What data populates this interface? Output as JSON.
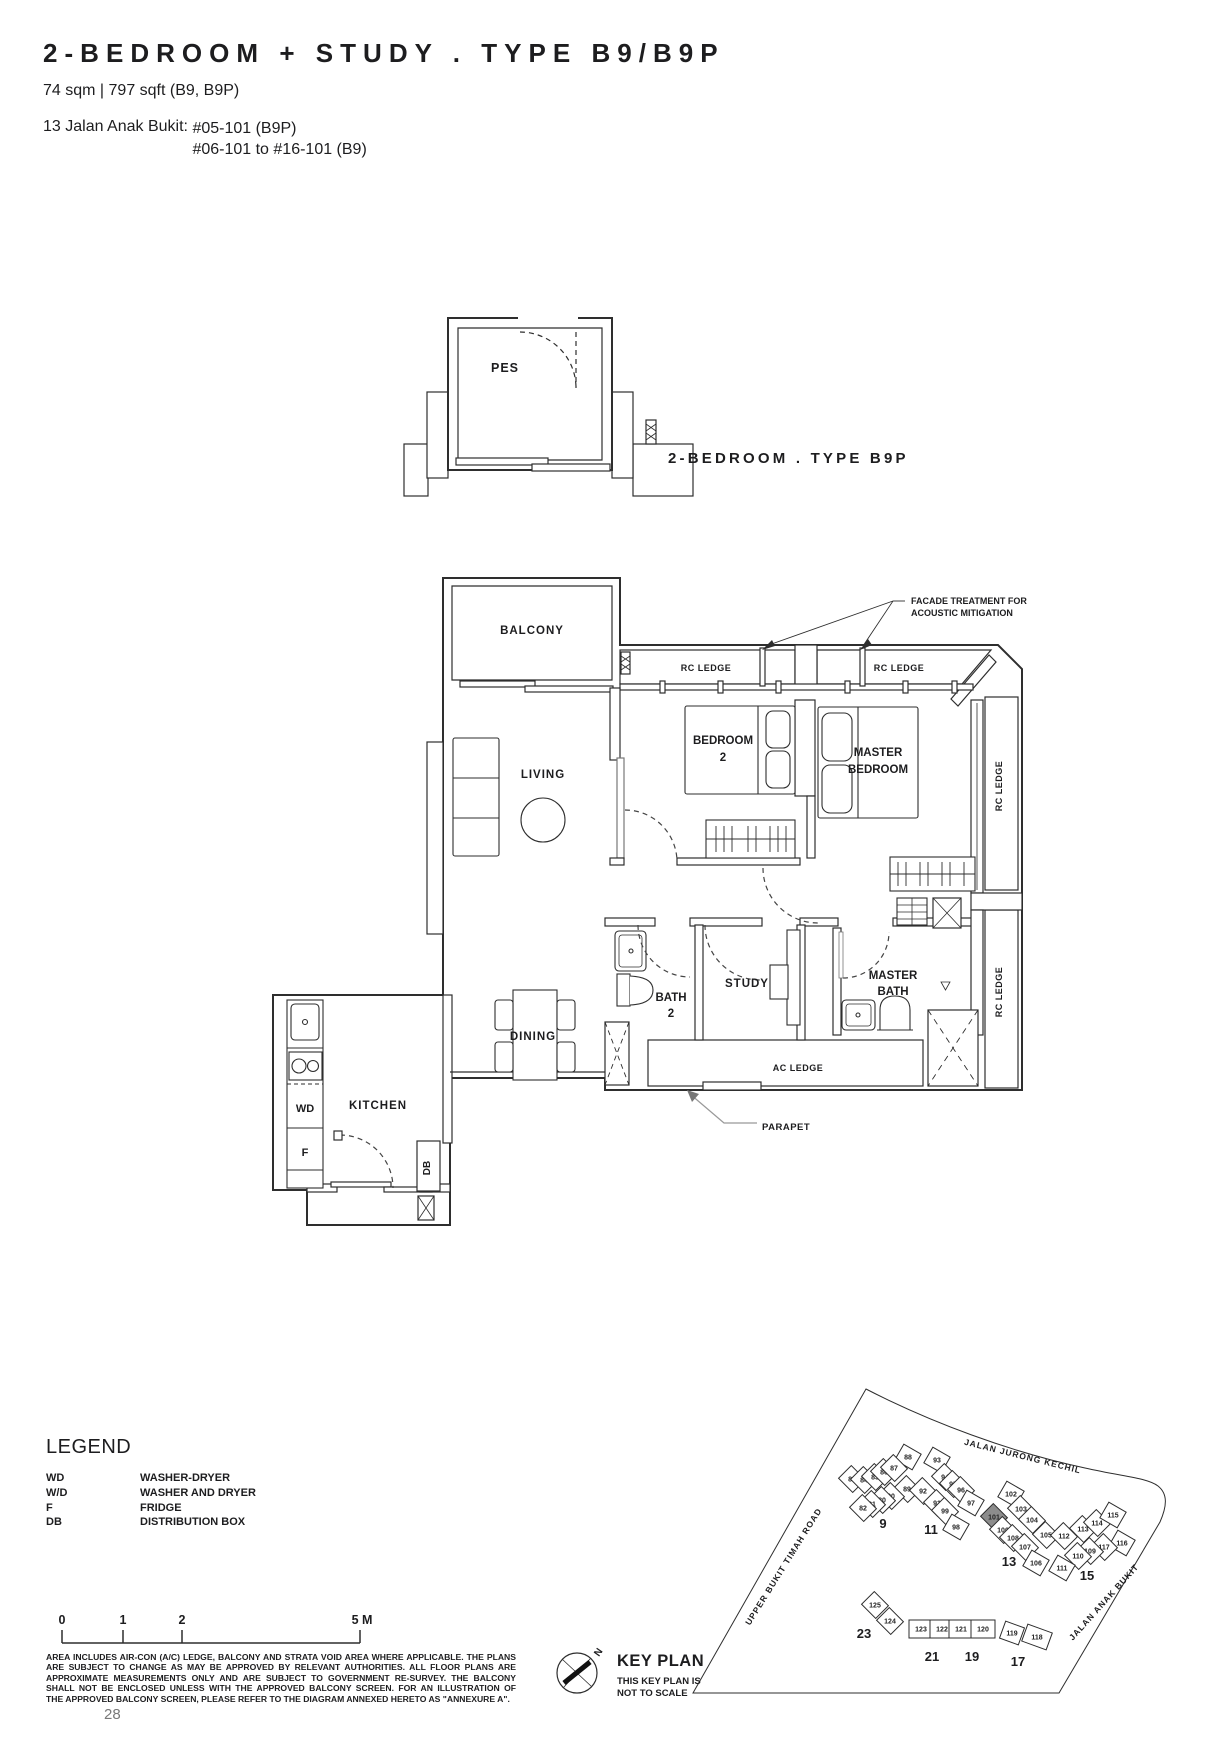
{
  "header": {
    "title": "2-BEDROOM + STUDY . TYPE B9/B9P",
    "area": "74 sqm | 797 sqft (B9, B9P)",
    "address_label": "13 Jalan Anak Bukit: ",
    "address_line1": "#05-101 (B9P)",
    "address_line2": "#06-101 to #16-101 (B9)"
  },
  "page": {
    "number": "28"
  },
  "floor_plan": {
    "labels": [
      {
        "name": "pes-label",
        "text": "PES",
        "x": 505,
        "y": 372,
        "size": 12.5,
        "ls": 1
      },
      {
        "name": "variant-type-label",
        "text": "2-BEDROOM . TYPE B9P",
        "x": 668,
        "y": 463,
        "size": 15,
        "ls": 3.2,
        "anchor": "start"
      },
      {
        "name": "balcony-label",
        "text": "BALCONY",
        "x": 532,
        "y": 634,
        "size": 11.5,
        "ls": 1
      },
      {
        "name": "rc-ledge-label-1",
        "text": "RC LEDGE",
        "x": 706,
        "y": 671,
        "size": 9,
        "ls": 0.5
      },
      {
        "name": "rc-ledge-label-2",
        "text": "RC LEDGE",
        "x": 899,
        "y": 671,
        "size": 9,
        "ls": 0.5
      },
      {
        "name": "facade-treatment-note",
        "lines": [
          "FACADE TREATMENT FOR",
          "ACOUSTIC MITIGATION"
        ],
        "x": 911,
        "y": 604,
        "size": 9,
        "anchor": "start",
        "dy": 12
      },
      {
        "name": "living-label",
        "text": "LIVING",
        "x": 543,
        "y": 778,
        "size": 11.5,
        "ls": 1
      },
      {
        "name": "bedroom2-label",
        "lines": [
          "BEDROOM",
          "2"
        ],
        "x": 723,
        "y": 744,
        "size": 11.5,
        "dy": 17
      },
      {
        "name": "master-bedroom-label",
        "lines": [
          "MASTER",
          "BEDROOM"
        ],
        "x": 878,
        "y": 756,
        "size": 11.5,
        "dy": 17
      },
      {
        "name": "rc-ledge-label-right-top",
        "text": "RC LEDGE",
        "x": 1002,
        "y": 786,
        "size": 9,
        "rot": -90,
        "ls": 0.5
      },
      {
        "name": "rc-ledge-label-right-bottom",
        "text": "RC LEDGE",
        "x": 1002,
        "y": 992,
        "size": 9,
        "rot": -90,
        "ls": 0.5
      },
      {
        "name": "bath2-label",
        "lines": [
          "BATH",
          "2"
        ],
        "x": 671,
        "y": 1001,
        "size": 11.5,
        "dy": 16
      },
      {
        "name": "study-label",
        "text": "STUDY",
        "x": 747,
        "y": 987,
        "size": 11.5,
        "ls": 1
      },
      {
        "name": "master-bath-label",
        "lines": [
          "MASTER",
          "BATH"
        ],
        "x": 893,
        "y": 979,
        "size": 11.5,
        "dy": 16
      },
      {
        "name": "dining-label",
        "text": "DINING",
        "x": 533,
        "y": 1040,
        "size": 11.5,
        "ls": 1
      },
      {
        "name": "ac-ledge-label",
        "text": "AC LEDGE",
        "x": 798,
        "y": 1071,
        "size": 9,
        "ls": 0.5
      },
      {
        "name": "parapet-label",
        "text": "PARAPET",
        "x": 762,
        "y": 1130,
        "size": 9.5,
        "anchor": "start",
        "ls": 0.5
      },
      {
        "name": "kitchen-label",
        "text": "KITCHEN",
        "x": 378,
        "y": 1109,
        "size": 11.5,
        "ls": 1
      },
      {
        "name": "washer-dryer-label",
        "text": "WD",
        "x": 305,
        "y": 1112,
        "size": 11
      },
      {
        "name": "fridge-label",
        "text": "F",
        "x": 305,
        "y": 1156,
        "size": 11
      },
      {
        "name": "distribution-box-label",
        "text": "DB",
        "x": 430,
        "y": 1168,
        "size": 10,
        "rot": -90
      }
    ]
  },
  "legend": {
    "title": "LEGEND",
    "items": [
      {
        "abbr": "WD",
        "desc": "WASHER-DRYER"
      },
      {
        "abbr": "W/D",
        "desc": "WASHER AND DRYER"
      },
      {
        "abbr": "F",
        "desc": "FRIDGE"
      },
      {
        "abbr": "DB",
        "desc": "DISTRIBUTION BOX"
      }
    ]
  },
  "scale_bar": {
    "labels": [
      {
        "t": "0",
        "x": 62
      },
      {
        "t": "1",
        "x": 123
      },
      {
        "t": "2",
        "x": 182
      },
      {
        "t": "5 M",
        "x": 362
      }
    ]
  },
  "disclaimer": {
    "lines": [
      "AREA INCLUDES AIR-CON (A/C) LEDGE, BALCONY AND STRATA VOID AREA WHERE APPLICABLE. THE PLANS",
      "ARE SUBJECT TO CHANGE AS MAY BE APPROVED BY RELEVANT AUTHORITIES. ALL FLOOR PLANS ARE",
      "APPROXIMATE MEASUREMENTS ONLY AND ARE SUBJECT TO GOVERNMENT RE-SURVEY. THE BALCONY",
      "SHALL NOT BE ENCLOSED UNLESS WITH THE APPROVED BALCONY SCREEN. FOR AN ILLUSTRATION OF",
      "THE APPROVED BALCONY SCREEN, PLEASE REFER TO THE DIAGRAM ANNEXED HERETO AS \"ANNEXURE A\"."
    ]
  },
  "key_plan": {
    "title": "KEY PLAN",
    "note_line1": "THIS KEY PLAN IS",
    "note_line2": "NOT TO SCALE",
    "north_label": "N",
    "highlight_color": "#8c8c8c",
    "roads": [
      {
        "name": "road-jalan-jurong-kechil",
        "label": "JALAN JURONG KECHIL",
        "x": 1022,
        "y": 1459,
        "rot": 14
      },
      {
        "name": "road-upper-bukit-timah",
        "label": "UPPER BUKIT TIMAH ROAD",
        "x": 786,
        "y": 1568,
        "rot": -58
      },
      {
        "name": "road-jalan-anak-bukit",
        "label": "JALAN ANAK BUKIT",
        "x": 1106,
        "y": 1604,
        "rot": -48
      }
    ],
    "blocks": [
      {
        "label": "9",
        "x": 883,
        "y": 1528
      },
      {
        "label": "11",
        "x": 931,
        "y": 1534
      },
      {
        "label": "13",
        "x": 1009,
        "y": 1566
      },
      {
        "label": "15",
        "x": 1087,
        "y": 1580
      },
      {
        "label": "23",
        "x": 864,
        "y": 1638
      },
      {
        "label": "21",
        "x": 932,
        "y": 1661
      },
      {
        "label": "19",
        "x": 972,
        "y": 1661
      },
      {
        "label": "17",
        "x": 1018,
        "y": 1666
      }
    ],
    "units": [
      {
        "n": "88",
        "x": 908,
        "y": 1457,
        "rot": 30
      },
      {
        "n": "83",
        "x": 852,
        "y": 1479,
        "rot": 45
      },
      {
        "n": "84",
        "x": 864,
        "y": 1480,
        "rot": 45
      },
      {
        "n": "85",
        "x": 875,
        "y": 1477,
        "rot": 45
      },
      {
        "n": "86",
        "x": 884,
        "y": 1472,
        "rot": 45
      },
      {
        "n": "87",
        "x": 894,
        "y": 1468,
        "rot": 45
      },
      {
        "n": "89",
        "x": 907,
        "y": 1489,
        "rot": 45
      },
      {
        "n": "90",
        "x": 891,
        "y": 1496,
        "rot": 45
      },
      {
        "n": "80",
        "x": 882,
        "y": 1500,
        "rot": 45
      },
      {
        "n": "81",
        "x": 872,
        "y": 1504,
        "rot": 45
      },
      {
        "n": "82",
        "x": 863,
        "y": 1508,
        "rot": 45
      },
      {
        "n": "93",
        "x": 937,
        "y": 1460,
        "rot": 30
      },
      {
        "n": "94",
        "x": 945,
        "y": 1477,
        "rot": 45
      },
      {
        "n": "95",
        "x": 953,
        "y": 1484,
        "rot": 45
      },
      {
        "n": "96",
        "x": 961,
        "y": 1490,
        "rot": 45
      },
      {
        "n": "92",
        "x": 923,
        "y": 1491,
        "rot": 45
      },
      {
        "n": "91",
        "x": 937,
        "y": 1503,
        "rot": 45
      },
      {
        "n": "99",
        "x": 945,
        "y": 1511,
        "rot": 45
      },
      {
        "n": "97",
        "x": 971,
        "y": 1503,
        "rot": 30
      },
      {
        "n": "98",
        "x": 956,
        "y": 1527,
        "rot": 30
      },
      {
        "n": "102",
        "x": 1011,
        "y": 1494,
        "rot": 30
      },
      {
        "n": "103",
        "x": 1021,
        "y": 1509,
        "rot": 45
      },
      {
        "n": "101",
        "x": 994,
        "y": 1517,
        "rot": 45,
        "hl": true
      },
      {
        "n": "104",
        "x": 1032,
        "y": 1520,
        "rot": 45
      },
      {
        "n": "100",
        "x": 1003,
        "y": 1530,
        "rot": 45
      },
      {
        "n": "108",
        "x": 1013,
        "y": 1538,
        "rot": 45
      },
      {
        "n": "107",
        "x": 1025,
        "y": 1547,
        "rot": 45
      },
      {
        "n": "106",
        "x": 1036,
        "y": 1563,
        "rot": 30
      },
      {
        "n": "105",
        "x": 1046,
        "y": 1535,
        "rot": 45
      },
      {
        "n": "112",
        "x": 1064,
        "y": 1536,
        "rot": 45
      },
      {
        "n": "113",
        "x": 1083,
        "y": 1529,
        "rot": 45
      },
      {
        "n": "114",
        "x": 1097,
        "y": 1523,
        "rot": 45
      },
      {
        "n": "115",
        "x": 1113,
        "y": 1515,
        "rot": 30
      },
      {
        "n": "116",
        "x": 1122,
        "y": 1543,
        "rot": 30
      },
      {
        "n": "117",
        "x": 1104,
        "y": 1547,
        "rot": 45
      },
      {
        "n": "109",
        "x": 1090,
        "y": 1551,
        "rot": 45
      },
      {
        "n": "110",
        "x": 1078,
        "y": 1556,
        "rot": 45
      },
      {
        "n": "111",
        "x": 1062,
        "y": 1568,
        "rot": 30
      },
      {
        "n": "125",
        "x": 875,
        "y": 1605,
        "rot": 45
      },
      {
        "n": "124",
        "x": 890,
        "y": 1621,
        "rot": 45
      },
      {
        "n": "123",
        "x": 921,
        "y": 1629,
        "rot": 0,
        "w": 24
      },
      {
        "n": "122",
        "x": 942,
        "y": 1629,
        "rot": 0,
        "w": 24
      },
      {
        "n": "121",
        "x": 961,
        "y": 1629,
        "rot": 0,
        "w": 24
      },
      {
        "n": "120",
        "x": 983,
        "y": 1629,
        "rot": 0,
        "w": 24
      },
      {
        "n": "119",
        "x": 1012,
        "y": 1633,
        "rot": 20
      },
      {
        "n": "118",
        "x": 1037,
        "y": 1637,
        "rot": 20,
        "w": 26
      }
    ]
  }
}
